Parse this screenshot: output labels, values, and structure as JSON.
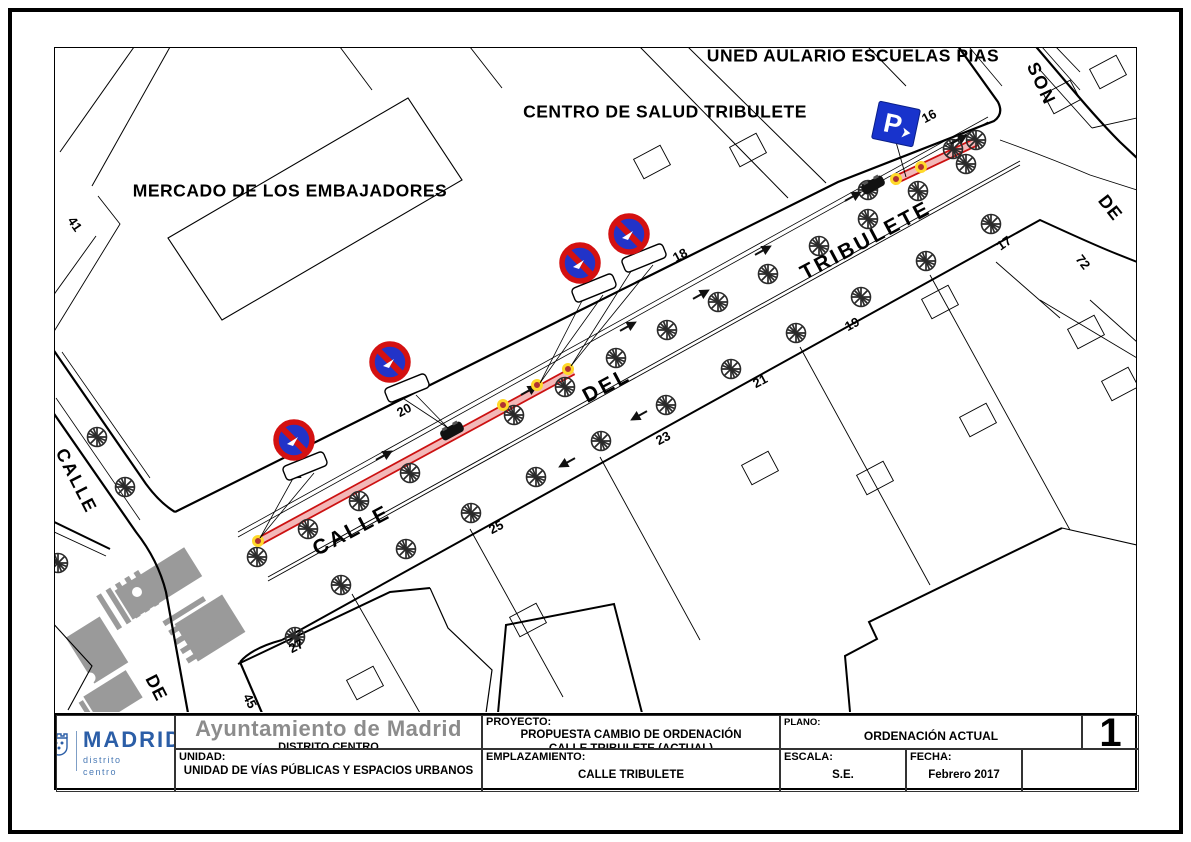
{
  "title_block": {
    "logo": {
      "brand": "MADRID",
      "sub1": "distrito",
      "sub2": "centro"
    },
    "org": "Ayuntamiento de Madrid",
    "org_sub": "DISTRITO CENTRO",
    "unit_label": "UNIDAD:",
    "unit_value": "UNIDAD DE VÍAS PÚBLICAS Y ESPACIOS URBANOS",
    "project_label": "PROYECTO:",
    "project_line1": "PROPUESTA  CAMBIO DE ORDENACIÓN",
    "project_line2": "CALLE  TRIBULETE (ACTUAL)",
    "location_label": "EMPLAZAMIENTO:",
    "location_value": "CALLE  TRIBULETE",
    "plan_label": "PLANO:",
    "plan_value": "ORDENACIÓN  ACTUAL",
    "scale_label": "ESCALA:",
    "scale_value": "S.E.",
    "date_label": "FECHA:",
    "date_value": "Febrero 2017",
    "sheet": "1"
  },
  "map": {
    "colors": {
      "sign_blue": "#2233c8",
      "sign_red": "#d41111",
      "parking_blue": "#1833cc",
      "highlight_red": "#cc1111",
      "highlight_pink": "#f3b8b8",
      "bollard_yellow": "#ffd92a",
      "bollard_red": "#b03232",
      "gray": "#9a9a9a"
    },
    "labels": [
      {
        "text": "UNED AULARIO ESCUELAS PIAS",
        "x": 853,
        "y": 56,
        "rot": 0,
        "size": 17.5,
        "ls": 0.5,
        "kind": "building"
      },
      {
        "text": "CENTRO DE SALUD TRIBULETE",
        "x": 665,
        "y": 112,
        "rot": 0,
        "size": 17.5,
        "ls": 0.5,
        "kind": "building"
      },
      {
        "text": "MERCADO DE LOS EMBAJADORES",
        "x": 290,
        "y": 191,
        "rot": 0,
        "size": 17.5,
        "ls": 0.5,
        "kind": "building"
      },
      {
        "text": "CALLE",
        "x": 352,
        "y": 531,
        "rot": -28,
        "size": 21,
        "ls": 3,
        "kind": "street"
      },
      {
        "text": "DEL",
        "x": 607,
        "y": 386,
        "rot": -28,
        "size": 21,
        "ls": 3,
        "kind": "street"
      },
      {
        "text": "TRIBULETE",
        "x": 866,
        "y": 241,
        "rot": -28,
        "size": 21,
        "ls": 3,
        "kind": "street"
      },
      {
        "text": "CALLE",
        "x": 76,
        "y": 481,
        "rot": 63,
        "size": 18,
        "ls": 2,
        "kind": "street"
      },
      {
        "text": "DE",
        "x": 156,
        "y": 688,
        "rot": 63,
        "size": 18,
        "ls": 1,
        "kind": "street"
      },
      {
        "text": "SON",
        "x": 1041,
        "y": 84,
        "rot": 65,
        "size": 18,
        "ls": 2,
        "kind": "street"
      },
      {
        "text": "DE",
        "x": 1110,
        "y": 208,
        "rot": 52,
        "size": 18,
        "ls": 1,
        "kind": "street"
      },
      {
        "text": "41",
        "x": 75,
        "y": 224,
        "rot": 55,
        "size": 13,
        "ls": 0,
        "kind": "num"
      },
      {
        "text": "20",
        "x": 404,
        "y": 410,
        "rot": -28,
        "size": 13,
        "ls": 0,
        "kind": "num"
      },
      {
        "text": "18",
        "x": 680,
        "y": 255,
        "rot": -28,
        "size": 13,
        "ls": 0,
        "kind": "num"
      },
      {
        "text": "16",
        "x": 929,
        "y": 116,
        "rot": -28,
        "size": 13,
        "ls": 0,
        "kind": "num"
      },
      {
        "text": "25",
        "x": 496,
        "y": 527,
        "rot": -28,
        "size": 13,
        "ls": 0,
        "kind": "num"
      },
      {
        "text": "27",
        "x": 296,
        "y": 646,
        "rot": -28,
        "size": 13,
        "ls": 0,
        "kind": "num"
      },
      {
        "text": "45",
        "x": 250,
        "y": 701,
        "rot": 63,
        "size": 13,
        "ls": 0,
        "kind": "num"
      },
      {
        "text": "23",
        "x": 663,
        "y": 438,
        "rot": -28,
        "size": 13,
        "ls": 0,
        "kind": "num"
      },
      {
        "text": "21",
        "x": 760,
        "y": 381,
        "rot": -28,
        "size": 13,
        "ls": 0,
        "kind": "num"
      },
      {
        "text": "19",
        "x": 852,
        "y": 324,
        "rot": -28,
        "size": 13,
        "ls": 0,
        "kind": "num"
      },
      {
        "text": "17",
        "x": 1004,
        "y": 243,
        "rot": -35,
        "size": 13,
        "ls": 0,
        "kind": "num"
      },
      {
        "text": "72",
        "x": 1083,
        "y": 262,
        "rot": 52,
        "size": 13,
        "ls": 0,
        "kind": "num"
      }
    ],
    "no_parking_signs": [
      {
        "cx": 294,
        "cy": 440,
        "plate_x": 305,
        "plate_y": 466,
        "plate_rot": -22,
        "tx": 260,
        "ty": 538
      },
      {
        "cx": 390,
        "cy": 362,
        "plate_x": 407,
        "plate_y": 388,
        "plate_rot": -22,
        "tx": 448,
        "ty": 428
      },
      {
        "cx": 580,
        "cy": 263,
        "plate_x": 594,
        "plate_y": 288,
        "plate_rot": -22,
        "tx": 540,
        "ty": 383
      },
      {
        "cx": 629,
        "cy": 234,
        "plate_x": 644,
        "plate_y": 258,
        "plate_rot": -22,
        "tx": 571,
        "ty": 366
      }
    ],
    "parking_sign": {
      "cx": 896,
      "cy": 124,
      "rot": 12,
      "tx": 906,
      "ty": 177,
      "label": "P"
    },
    "highlight_segments": [
      {
        "x1": 258,
        "y1": 542,
        "x2": 573,
        "y2": 371
      },
      {
        "x1": 893,
        "y1": 181,
        "x2": 976,
        "y2": 142
      }
    ],
    "bollards": [
      [
        258,
        541
      ],
      [
        503,
        405
      ],
      [
        537,
        385
      ],
      [
        568,
        369
      ],
      [
        896,
        179
      ],
      [
        921,
        167
      ]
    ],
    "cars": [
      [
        452,
        431,
        -29
      ],
      [
        873,
        185,
        -29
      ]
    ],
    "entrance_markers": [
      [
        383,
        456,
        -29
      ],
      [
        528,
        391,
        -29
      ],
      [
        627,
        327,
        -29
      ],
      [
        700,
        295,
        -29
      ],
      [
        762,
        251,
        -29
      ],
      [
        852,
        197,
        -29
      ],
      [
        958,
        140,
        -29
      ],
      [
        568,
        462,
        151
      ],
      [
        640,
        415,
        151
      ],
      [
        300,
        473,
        151
      ]
    ],
    "trees": [
      [
        257,
        557
      ],
      [
        308,
        529
      ],
      [
        359,
        501
      ],
      [
        410,
        473
      ],
      [
        514,
        415
      ],
      [
        565,
        387
      ],
      [
        616,
        358
      ],
      [
        667,
        330
      ],
      [
        718,
        302
      ],
      [
        768,
        274
      ],
      [
        819,
        246
      ],
      [
        868,
        219
      ],
      [
        918,
        191
      ],
      [
        966,
        164
      ],
      [
        341,
        585
      ],
      [
        406,
        549
      ],
      [
        471,
        513
      ],
      [
        536,
        477
      ],
      [
        601,
        441
      ],
      [
        666,
        405
      ],
      [
        731,
        369
      ],
      [
        796,
        333
      ],
      [
        861,
        297
      ],
      [
        926,
        261
      ],
      [
        991,
        224
      ],
      [
        97,
        437
      ],
      [
        125,
        487
      ],
      [
        58,
        563
      ],
      [
        295,
        637
      ],
      [
        868,
        190
      ],
      [
        953,
        149
      ],
      [
        976,
        140
      ]
    ]
  }
}
